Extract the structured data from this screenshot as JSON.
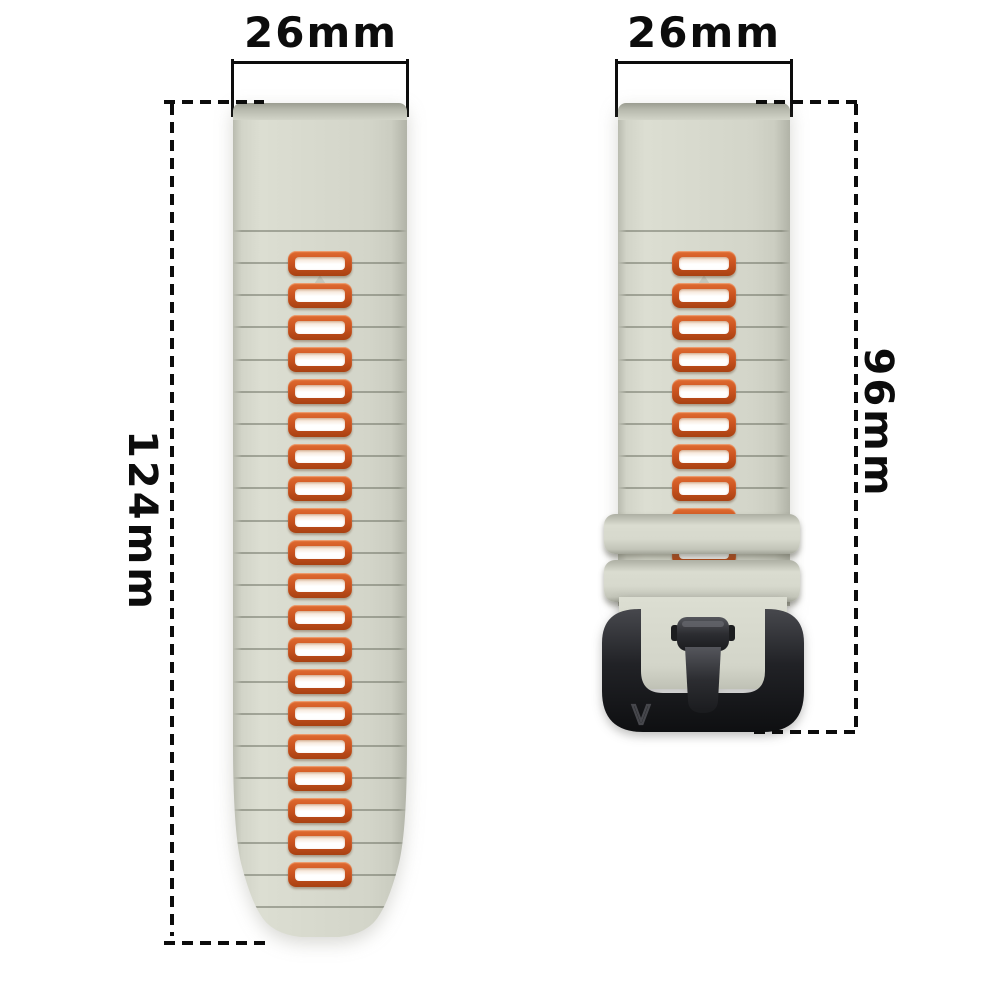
{
  "diagram": {
    "left_piece": {
      "width_label": "26mm",
      "length_label": "124mm",
      "slot_count": 20,
      "groove_count": 22
    },
    "right_piece": {
      "width_label": "26mm",
      "length_label": "96mm",
      "slot_count": 10,
      "groove_count": 10,
      "keeper_count": 2
    },
    "buckle": {
      "marking": "V"
    }
  },
  "colors": {
    "background": "#ffffff",
    "strap_base": "#d6d8cc",
    "strap_edge": "#b1b3a7",
    "slot_orange": "#cc5420",
    "slot_orange_light": "#e06c31",
    "slot_orange_dark": "#a84112",
    "slot_inner": "#ffffff",
    "buckle_black": "#1a1b1e",
    "dimension_ink": "#0c0c0c"
  }
}
